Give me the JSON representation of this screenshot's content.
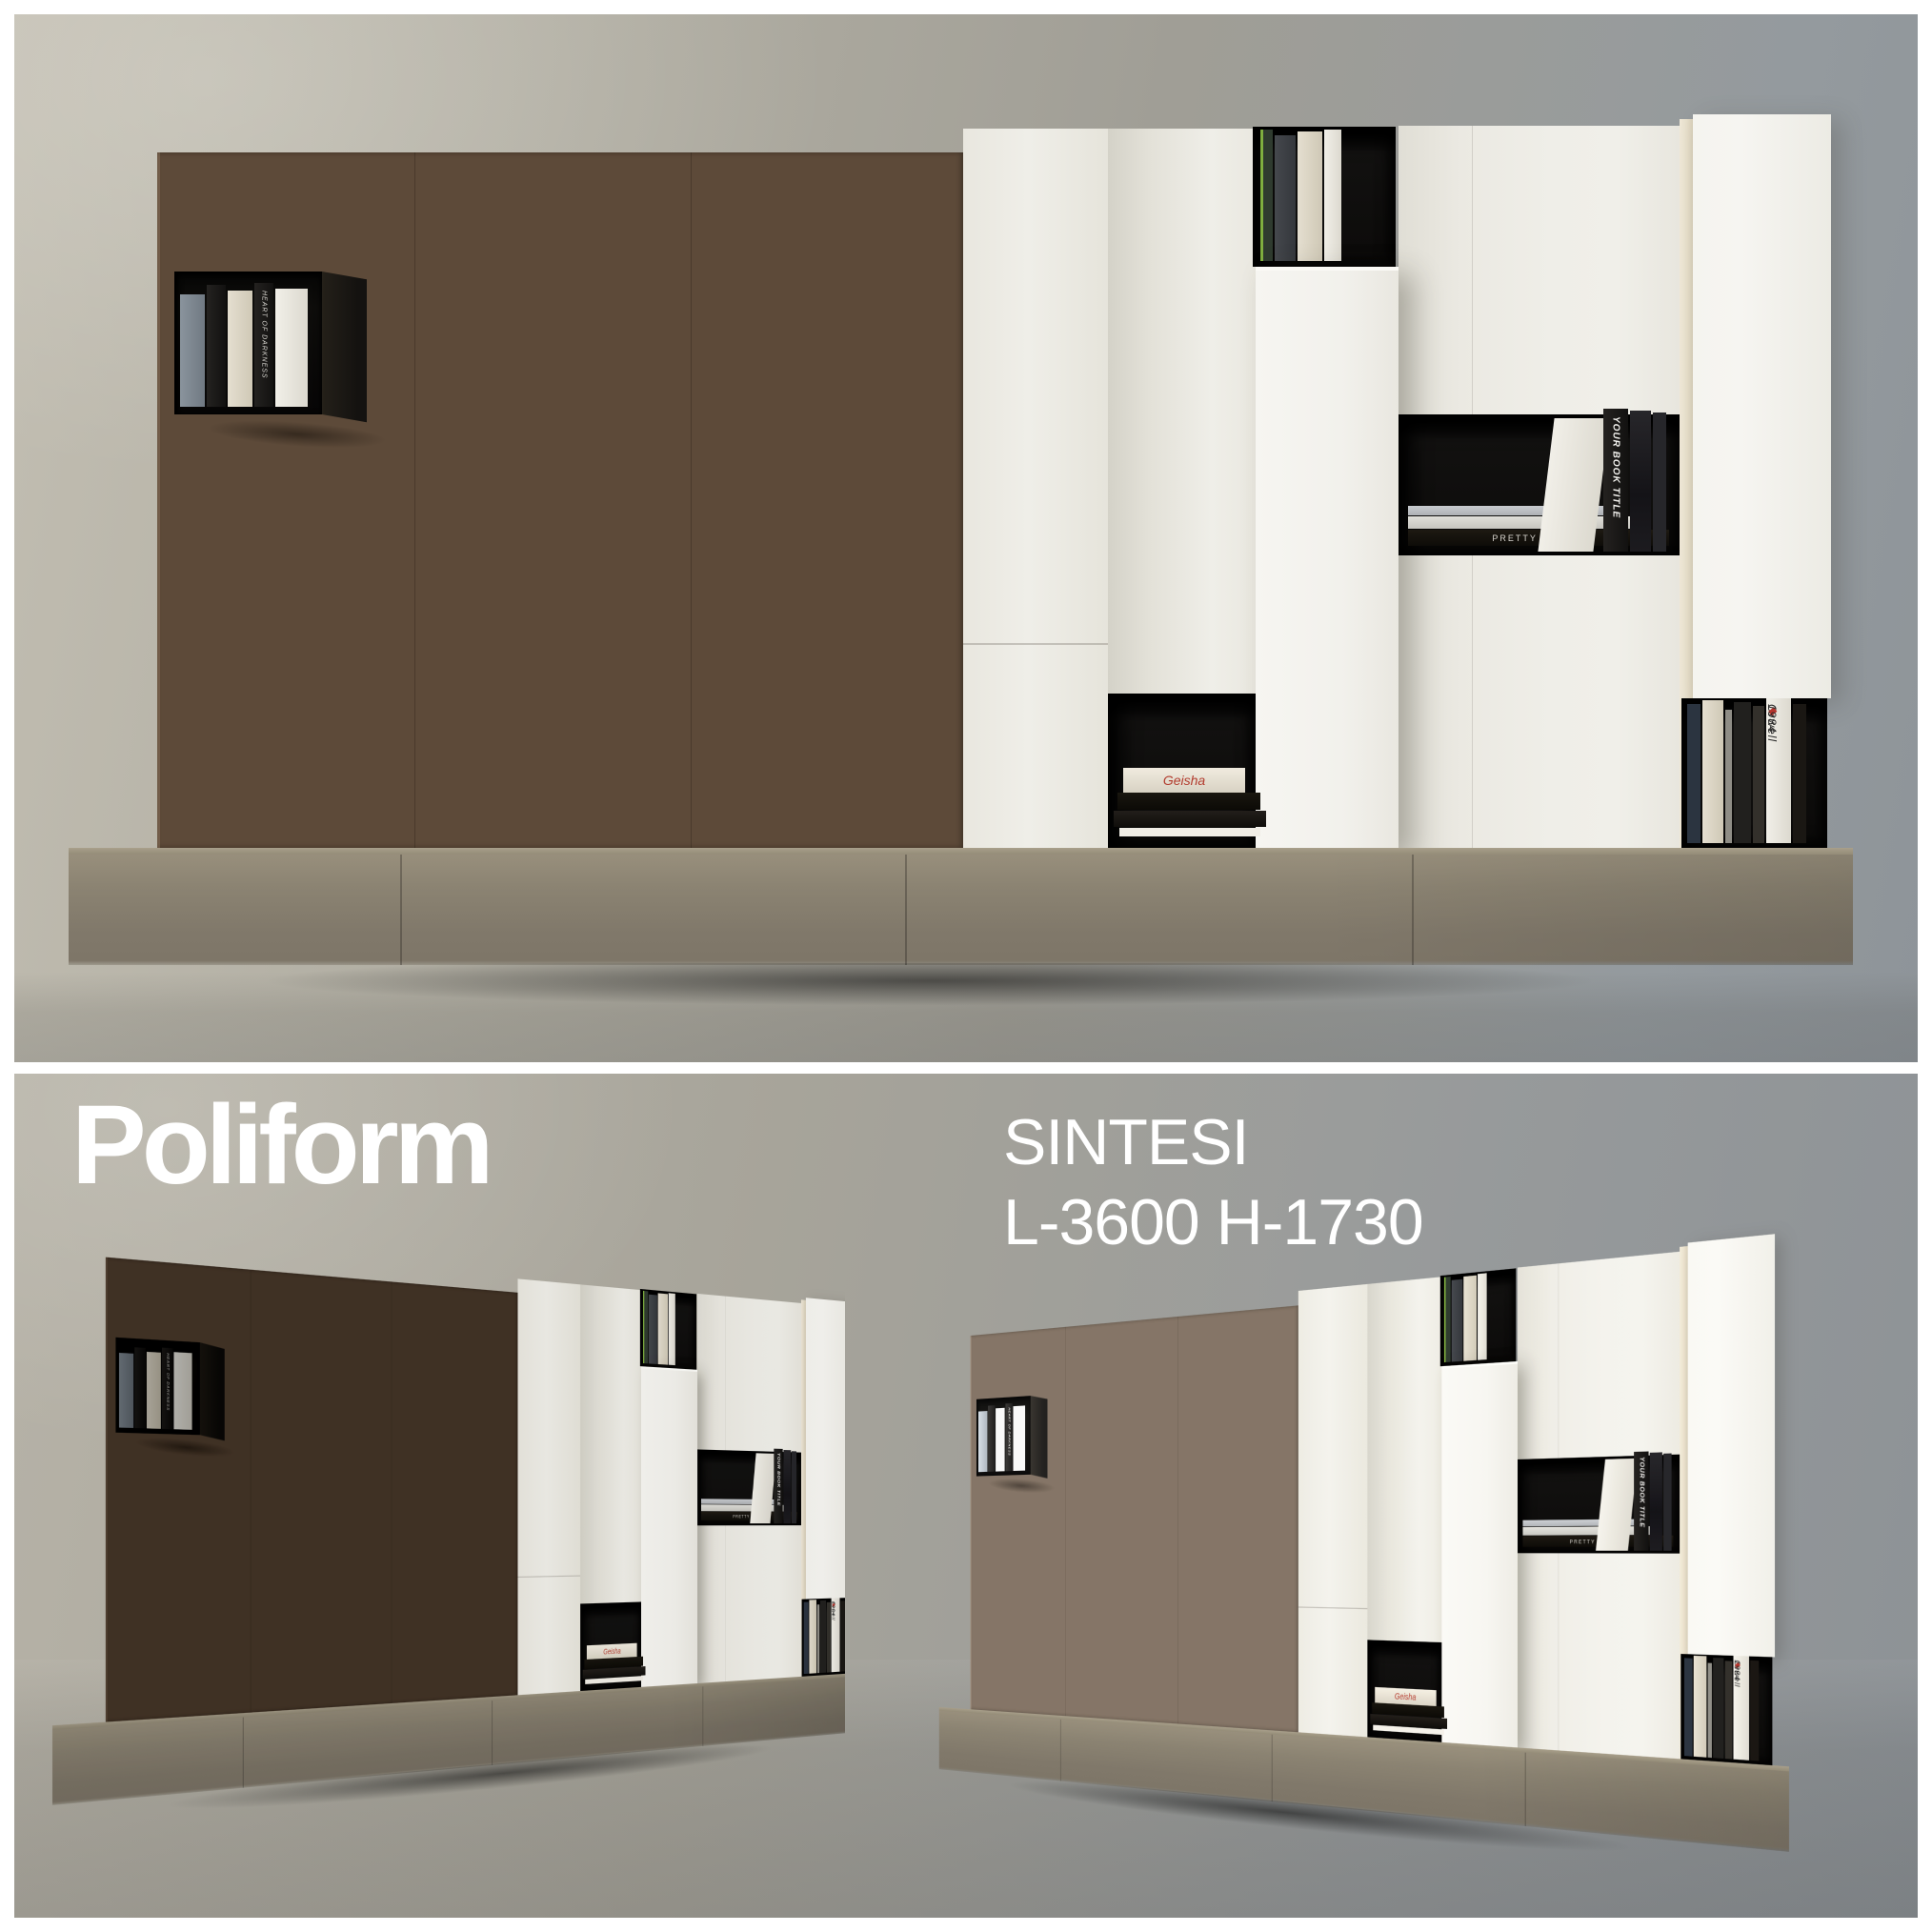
{
  "branding": {
    "brand": "Poliform",
    "product": "SINTESI",
    "dimensions": "L-3600 H-1730"
  },
  "books": {
    "cube_spine": "HEART OF DARKNESS",
    "middle_spine": "YOUR BOOK TITLE",
    "middle_stack": "PRETTY INSANE",
    "bottom_left_stack": "Geisha",
    "orwell_author": "Orwell",
    "orwell_mark": "◆",
    "orwell_year": "1984"
  },
  "palette": {
    "wall-a": "#c2beb2",
    "wall-b": "#949a9e",
    "wall-bot-a": "#b6b2a7",
    "wall-bot-b": "#8d9296",
    "wood-a": "#7a6450",
    "wood-b": "#5d4a39",
    "wood-c": "#473627",
    "white-a": "#f6f5f1",
    "white-b": "#efeee8",
    "white-c": "#e2e0d6",
    "cream": "#e7dfcb",
    "black-niche": "#0c0b0a",
    "console-a": "#988f7c",
    "console-b": "#7e7668",
    "text": "#ffffff"
  }
}
